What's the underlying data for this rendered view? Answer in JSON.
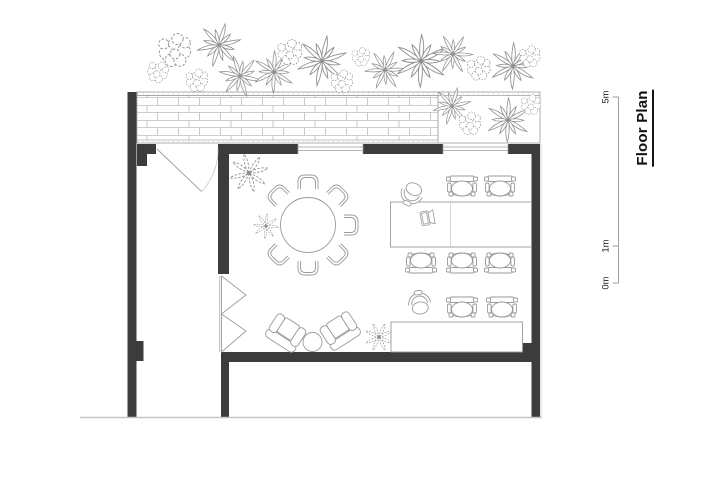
{
  "title": {
    "text": "Floor Plan"
  },
  "scale_bar": {
    "x": 618.5,
    "top": 97,
    "bottom": 283,
    "tick_len": 6,
    "labels": [
      {
        "text": "5m",
        "y": 97
      },
      {
        "text": "1m",
        "y": 246
      },
      {
        "text": "0m",
        "y": 283
      }
    ]
  },
  "colors": {
    "wall": "#3c3c3c",
    "line": "#9c9c9c",
    "light_line": "#c6c6c6",
    "brick": "#bdbdbd",
    "plant": "#8f8f8f",
    "furniture": "#9a9a9a",
    "scale": "#a0a0a0"
  },
  "plan": {
    "walls": [
      {
        "name": "left-wall",
        "x": 127.5,
        "y": 92,
        "w": 9,
        "h": 325
      },
      {
        "name": "left-wall-column",
        "x": 136.5,
        "y": 341,
        "w": 7,
        "h": 20
      },
      {
        "name": "top-wall-a",
        "x": 137,
        "y": 144,
        "w": 19,
        "h": 10
      },
      {
        "name": "entry-jamb",
        "x": 137,
        "y": 154,
        "w": 10,
        "h": 12
      },
      {
        "name": "interior-wall-top",
        "x": 218,
        "y": 144,
        "w": 11,
        "h": 130
      },
      {
        "name": "top-wall-b",
        "x": 218,
        "y": 144,
        "w": 80,
        "h": 10
      },
      {
        "name": "top-wall-c",
        "x": 363,
        "y": 144,
        "w": 80,
        "h": 10
      },
      {
        "name": "top-wall-d",
        "x": 508,
        "y": 144,
        "w": 32,
        "h": 10
      },
      {
        "name": "right-wall",
        "x": 531.5,
        "y": 144,
        "w": 8.5,
        "h": 274
      },
      {
        "name": "bottom-wall",
        "x": 228.5,
        "y": 352,
        "w": 294,
        "h": 10
      },
      {
        "name": "bottom-right-column",
        "x": 522,
        "y": 343,
        "w": 10,
        "h": 19
      },
      {
        "name": "interior-wall-bottom",
        "x": 221,
        "y": 352,
        "w": 8,
        "h": 65
      }
    ],
    "ground_line": {
      "x1": 80,
      "y1": 417.5,
      "x2": 542,
      "y2": 417.5
    },
    "outer_edge_line": {
      "x1": 541,
      "y1": 144,
      "x2": 541,
      "y2": 417.5
    },
    "planter": {
      "x": 137,
      "y": 92,
      "w": 403,
      "h": 51,
      "inner_top": 95.5,
      "inner_bottom": 140,
      "divider_x": 438,
      "brick_x": 137,
      "brick_w": 301
    },
    "windows": [
      {
        "x1": 298,
        "x2": 363,
        "lines": [
          147,
          150.5
        ]
      },
      {
        "x1": 443,
        "x2": 508,
        "lines": [
          147,
          150.5
        ]
      }
    ],
    "door": {
      "hinge_x": 157,
      "hinge_y": 149,
      "leaf_x": 201.6,
      "leaf_y": 191.6,
      "jamb_x": 218,
      "radius": 61
    },
    "bifold": {
      "track_x": 219.8,
      "top": 276,
      "bottom": 352,
      "triangles": [
        [
          [
            221.5,
            276
          ],
          [
            246,
            295
          ],
          [
            221.5,
            314
          ]
        ],
        [
          [
            221.5,
            314
          ],
          [
            246,
            331
          ],
          [
            221.5,
            352
          ]
        ]
      ]
    },
    "round_table": {
      "cx": 308,
      "cy": 225,
      "r": 27.5,
      "chair_dist": 37,
      "chair_angles": [
        -90,
        -45,
        0,
        45,
        90,
        135,
        -135
      ]
    },
    "desks": [
      {
        "x": 390.5,
        "y": 202,
        "w": 141,
        "h": 45,
        "divider_x": 450.5
      },
      {
        "x": 391,
        "y": 322,
        "w": 131.5,
        "h": 30
      }
    ],
    "task_chairs": [
      {
        "x": 462,
        "y": 189,
        "rot": 0
      },
      {
        "x": 500,
        "y": 189,
        "rot": 0
      },
      {
        "x": 421,
        "y": 260,
        "rot": 180
      },
      {
        "x": 462,
        "y": 260,
        "rot": 180
      },
      {
        "x": 500,
        "y": 260,
        "rot": 180
      },
      {
        "x": 462,
        "y": 310,
        "rot": 0
      },
      {
        "x": 502,
        "y": 310,
        "rot": 0
      }
    ],
    "swivel_chairs": [
      {
        "x": 413,
        "y": 191,
        "rot": 205
      },
      {
        "x": 420,
        "y": 306,
        "rot": -8
      }
    ],
    "laptop": {
      "x": 427,
      "y": 218,
      "rot": -100
    },
    "lounge_chairs": [
      {
        "x": 287,
        "y": 331,
        "rot": 33
      },
      {
        "x": 339,
        "y": 329,
        "rot": -33
      }
    ],
    "side_table": {
      "cx": 312.5,
      "cy": 342,
      "r": 9.5
    },
    "plants": [
      {
        "type": "cluster",
        "x": 175,
        "y": 54,
        "s": 1.25,
        "rot": 0
      },
      {
        "type": "cluster",
        "x": 157,
        "y": 74,
        "s": 0.8,
        "rot": 20
      },
      {
        "type": "frond",
        "x": 219,
        "y": 45,
        "s": 1.05,
        "rot": 15
      },
      {
        "type": "cluster",
        "x": 197,
        "y": 83,
        "s": 0.85,
        "rot": 0
      },
      {
        "type": "frond",
        "x": 240,
        "y": 76,
        "s": 1.0,
        "rot": 40
      },
      {
        "type": "frond",
        "x": 274,
        "y": 72,
        "s": 1.0,
        "rot": 0
      },
      {
        "type": "cluster",
        "x": 290,
        "y": 55,
        "s": 0.95,
        "rot": 0
      },
      {
        "type": "frond",
        "x": 322,
        "y": 61,
        "s": 1.2,
        "rot": 10
      },
      {
        "type": "cluster",
        "x": 342,
        "y": 84,
        "s": 0.85,
        "rot": 0
      },
      {
        "type": "cluster",
        "x": 361,
        "y": 59,
        "s": 0.7,
        "rot": 0
      },
      {
        "type": "frond",
        "x": 385,
        "y": 70,
        "s": 0.95,
        "rot": 25
      },
      {
        "type": "frond",
        "x": 421,
        "y": 61,
        "s": 1.25,
        "rot": 0
      },
      {
        "type": "frond",
        "x": 453,
        "y": 54,
        "s": 0.95,
        "rot": 30
      },
      {
        "type": "cluster",
        "x": 479,
        "y": 71,
        "s": 0.9,
        "rot": 0
      },
      {
        "type": "frond",
        "x": 513,
        "y": 66,
        "s": 1.1,
        "rot": 0
      },
      {
        "type": "cluster",
        "x": 530,
        "y": 59,
        "s": 0.8,
        "rot": 0
      },
      {
        "type": "frond",
        "x": 452,
        "y": 106,
        "s": 0.9,
        "rot": 15
      },
      {
        "type": "cluster",
        "x": 470,
        "y": 126,
        "s": 0.85,
        "rot": 0
      },
      {
        "type": "frond",
        "x": 508,
        "y": 120,
        "s": 1.05,
        "rot": 0
      },
      {
        "type": "cluster",
        "x": 531,
        "y": 107,
        "s": 0.75,
        "rot": 0
      },
      {
        "type": "xplant",
        "x": 249,
        "y": 173,
        "s": 1.15,
        "rot": 10
      },
      {
        "type": "xplant",
        "x": 266,
        "y": 226,
        "s": 0.75,
        "rot": 30
      },
      {
        "type": "xplant",
        "x": 379,
        "y": 337,
        "s": 0.85,
        "rot": 0
      }
    ]
  }
}
